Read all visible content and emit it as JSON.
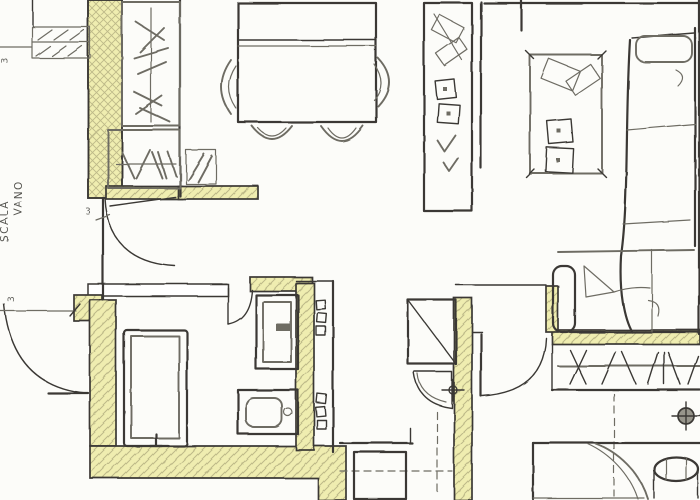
{
  "plan": {
    "title": "apartment-floor-plan-scan",
    "room_label": {
      "line1": "VANO",
      "line2": "SCALA"
    },
    "dimensions": {
      "top_left": "3",
      "left_mid": "3",
      "hall": "3"
    },
    "colors": {
      "paper": "#fcfcf9",
      "wall_highlight": "#efedb0",
      "wall_hatch": "#bdb988",
      "ink_dark": "#3a3934",
      "ink_mid": "#6e6c64",
      "ink_light": "#97958b"
    },
    "symbols": [
      "stair-window",
      "wardrobe-hangers",
      "closet-hangers",
      "dining-table",
      "chair-arcs",
      "tall-cabinet",
      "tv-table",
      "sofa-sectional",
      "armchair",
      "bathtub",
      "shower-box",
      "wc-bidet",
      "vent-shaft",
      "water-heater",
      "corner-basin",
      "bedside-table",
      "bed",
      "closet-rod-hangers",
      "ceiling-lamp",
      "door-swing"
    ]
  }
}
